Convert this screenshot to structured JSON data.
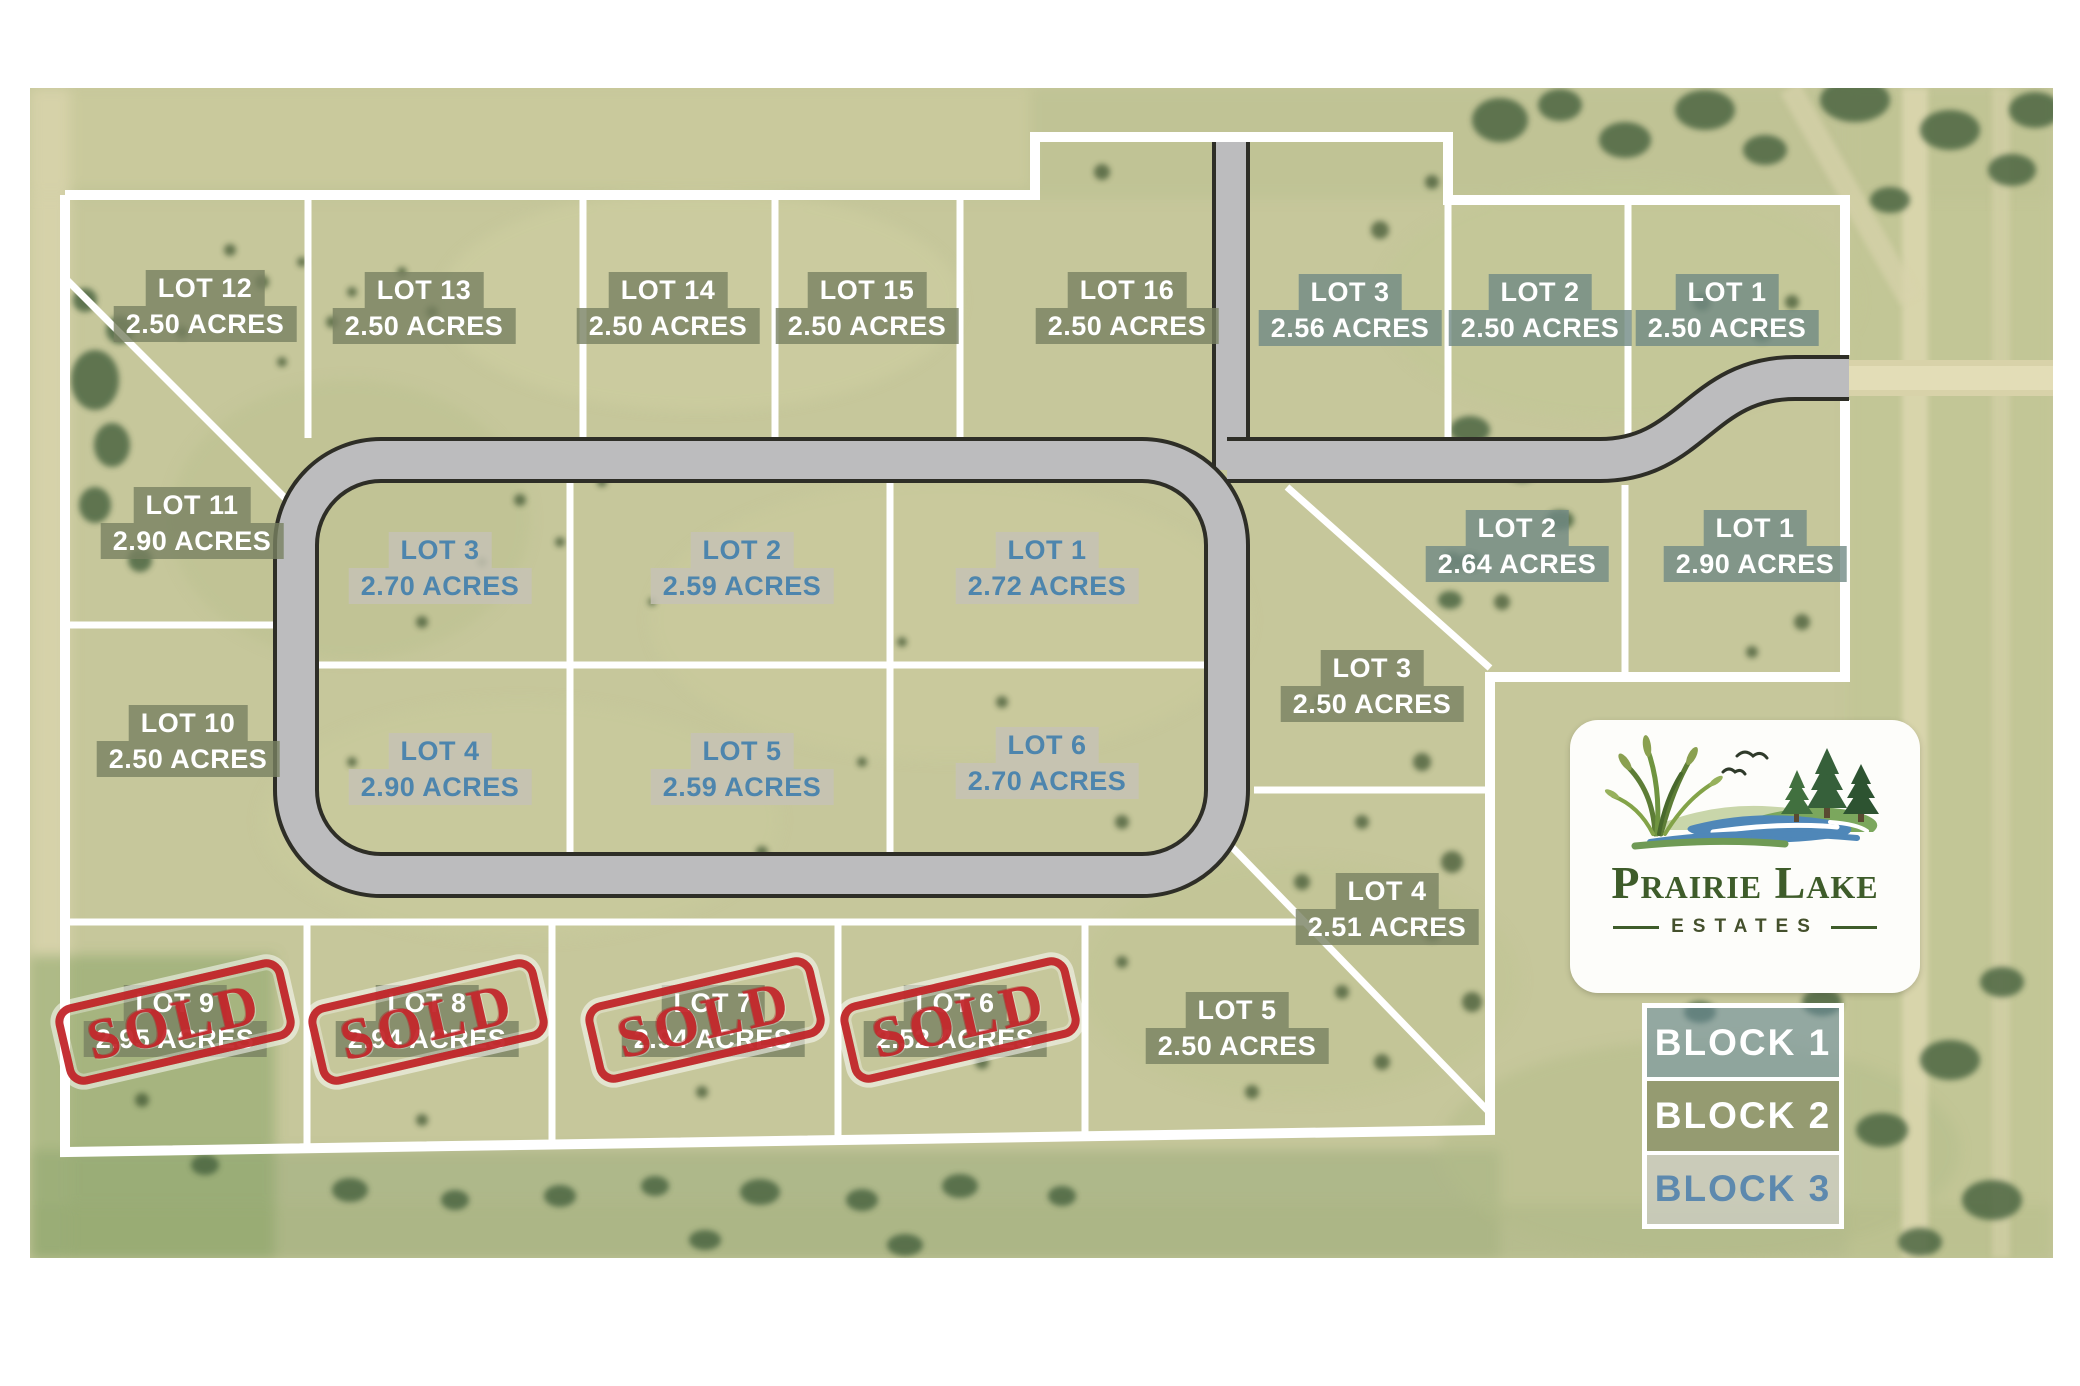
{
  "map": {
    "sold_stamp": "SOLD",
    "logo": {
      "name_top": "Prairie Lake",
      "name_bottom": "ESTATES"
    },
    "legend": [
      {
        "label": "BLOCK 1"
      },
      {
        "label": "BLOCK 2"
      },
      {
        "label": "BLOCK 3"
      }
    ],
    "colors": {
      "block1_chip": "#718a85",
      "block2_chip": "#788161",
      "block3_chip": "#c6c2b5",
      "block3_text": "#4d85ad",
      "sold_red": "#c2272c",
      "road_gray": "#bcbcbe",
      "line_white": "#ffffff",
      "grass_base": "#c6c79b",
      "logo_green": "#3e5c2a",
      "lake_blue": "#4f87b8"
    },
    "lots": [
      {
        "name": "LOT 12",
        "acreage": "2.50 ACRES",
        "block": "2",
        "sold": false
      },
      {
        "name": "LOT 13",
        "acreage": "2.50 ACRES",
        "block": "2",
        "sold": false
      },
      {
        "name": "LOT 14",
        "acreage": "2.50 ACRES",
        "block": "2",
        "sold": false
      },
      {
        "name": "LOT 15",
        "acreage": "2.50 ACRES",
        "block": "2",
        "sold": false
      },
      {
        "name": "LOT 16",
        "acreage": "2.50 ACRES",
        "block": "2",
        "sold": false
      },
      {
        "name": "LOT 3",
        "acreage": "2.56 ACRES",
        "block": "1",
        "sold": false
      },
      {
        "name": "LOT 2",
        "acreage": "2.50 ACRES",
        "block": "1",
        "sold": false
      },
      {
        "name": "LOT 1",
        "acreage": "2.50 ACRES",
        "block": "1",
        "sold": false
      },
      {
        "name": "LOT 11",
        "acreage": "2.90 ACRES",
        "block": "2",
        "sold": false
      },
      {
        "name": "LOT 10",
        "acreage": "2.50 ACRES",
        "block": "2",
        "sold": false
      },
      {
        "name": "LOT 3",
        "acreage": "2.70 ACRES",
        "block": "3",
        "sold": false
      },
      {
        "name": "LOT 2",
        "acreage": "2.59 ACRES",
        "block": "3",
        "sold": false
      },
      {
        "name": "LOT 1",
        "acreage": "2.72 ACRES",
        "block": "3",
        "sold": false
      },
      {
        "name": "LOT 4",
        "acreage": "2.90 ACRES",
        "block": "3",
        "sold": false
      },
      {
        "name": "LOT 5",
        "acreage": "2.59 ACRES",
        "block": "3",
        "sold": false
      },
      {
        "name": "LOT 6",
        "acreage": "2.70 ACRES",
        "block": "3",
        "sold": false
      },
      {
        "name": "LOT 2",
        "acreage": "2.64 ACRES",
        "block": "1",
        "sold": false
      },
      {
        "name": "LOT 1",
        "acreage": "2.90 ACRES",
        "block": "1",
        "sold": false
      },
      {
        "name": "LOT 3",
        "acreage": "2.50 ACRES",
        "block": "1",
        "sold": false
      },
      {
        "name": "LOT 4",
        "acreage": "2.51 ACRES",
        "block": "1",
        "sold": false
      },
      {
        "name": "LOT 5",
        "acreage": "2.50 ACRES",
        "block": "1",
        "sold": false
      },
      {
        "name": "LOT 9",
        "acreage": "2.95 ACRES",
        "block": "2",
        "sold": true
      },
      {
        "name": "LOT 8",
        "acreage": "2.94 ACRES",
        "block": "2",
        "sold": true
      },
      {
        "name": "LOT 7",
        "acreage": "2.94 ACRES",
        "block": "2",
        "sold": true
      },
      {
        "name": "LOT 6",
        "acreage": "2.52 ACRES",
        "block": "2",
        "sold": true
      }
    ]
  }
}
